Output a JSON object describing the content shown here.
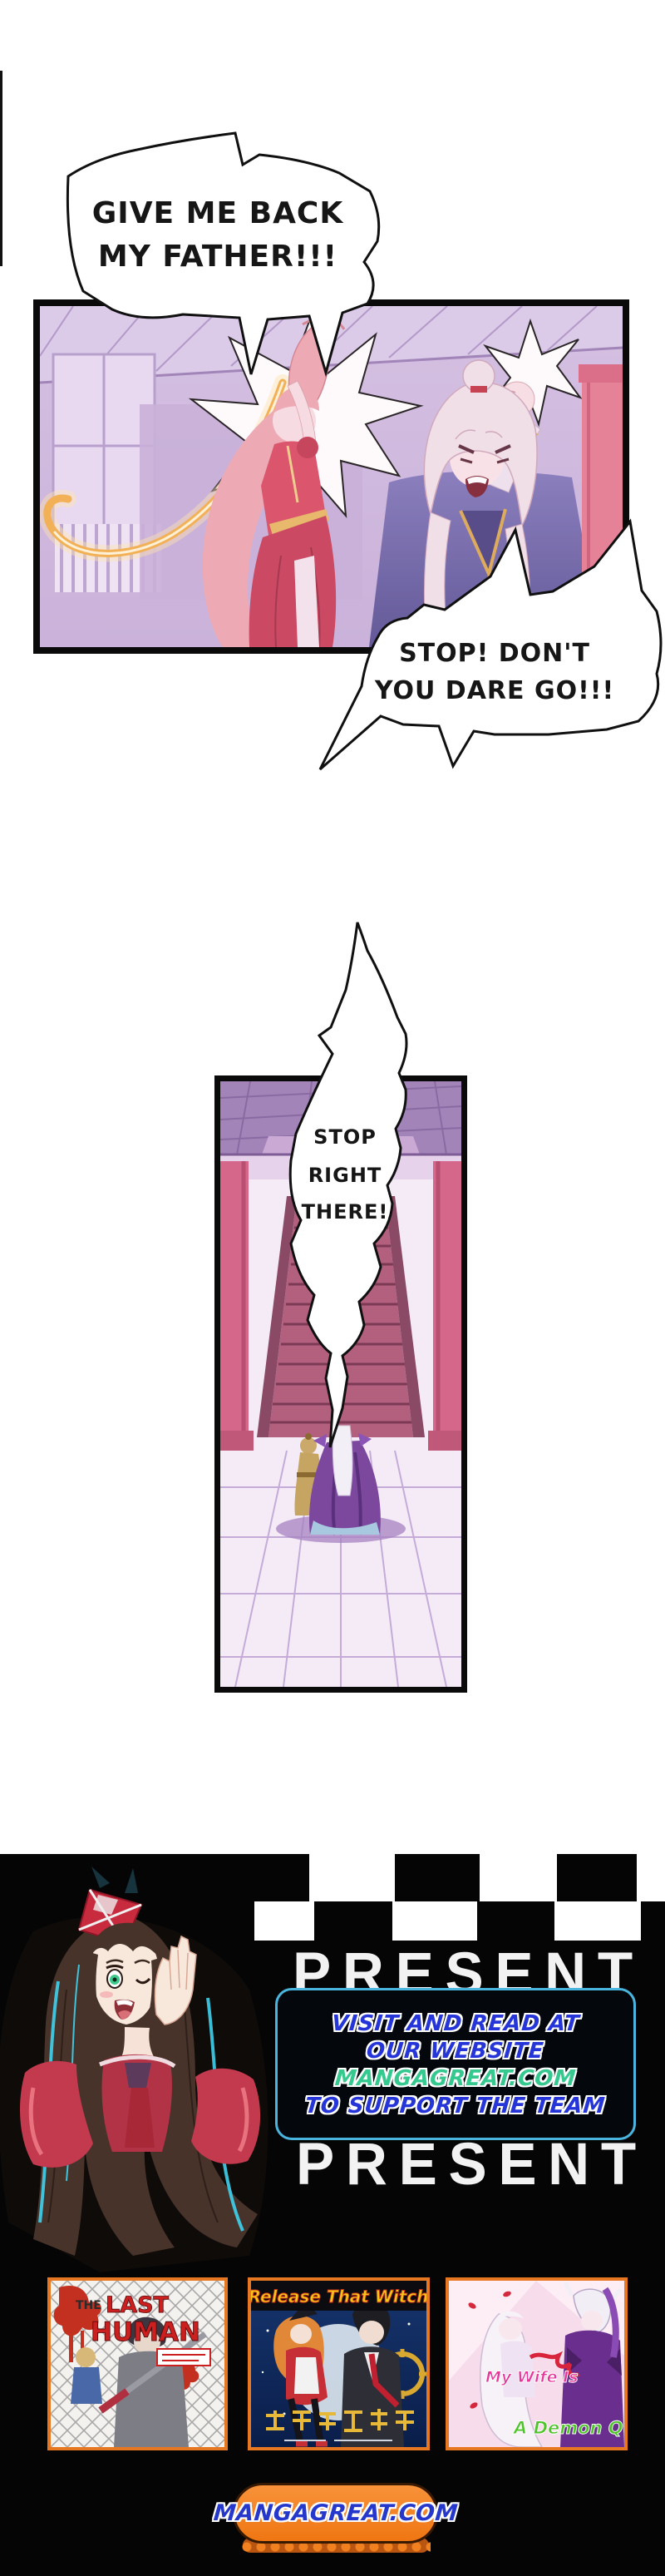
{
  "page": {
    "background": "#ffffff",
    "kind": "manga chapter page"
  },
  "dialogue": {
    "bubble1": {
      "line1": "GIVE ME BACK",
      "line2": "MY FATHER!!!"
    },
    "bubble2": {
      "line1": "STOP! DON'T",
      "line2": "YOU DARE GO!!!"
    },
    "bubble3": {
      "line1": "STOP",
      "line2": "RIGHT",
      "line3": "THERE!"
    }
  },
  "footer": {
    "present_label": "PRESENT",
    "present_label_2": "PRESENT",
    "promo_box": {
      "line1": "VISIT AND READ AT",
      "line2": "OUR WEBSITE",
      "line3": "MANGAGREAT.COM",
      "line4": "TO SUPPORT THE TEAM",
      "text_color_blue": "#2535d8",
      "text_color_green": "#35c98f",
      "border_color": "#49b4dd"
    },
    "covers": [
      {
        "title": "THE LAST HUMAN",
        "title_parts": [
          "THE",
          "LAST",
          "HUMAN"
        ]
      },
      {
        "title": "Release That Witch",
        "chinese_title": "放开那个女巫"
      },
      {
        "title": "My Wife Is A Demon Queen",
        "title_lines": [
          "My Wife Is",
          "A Demon Queen"
        ]
      }
    ],
    "site_button_label": "MANGAGREAT.COM",
    "accent_orange": "#f5821f",
    "background": "#050505"
  }
}
